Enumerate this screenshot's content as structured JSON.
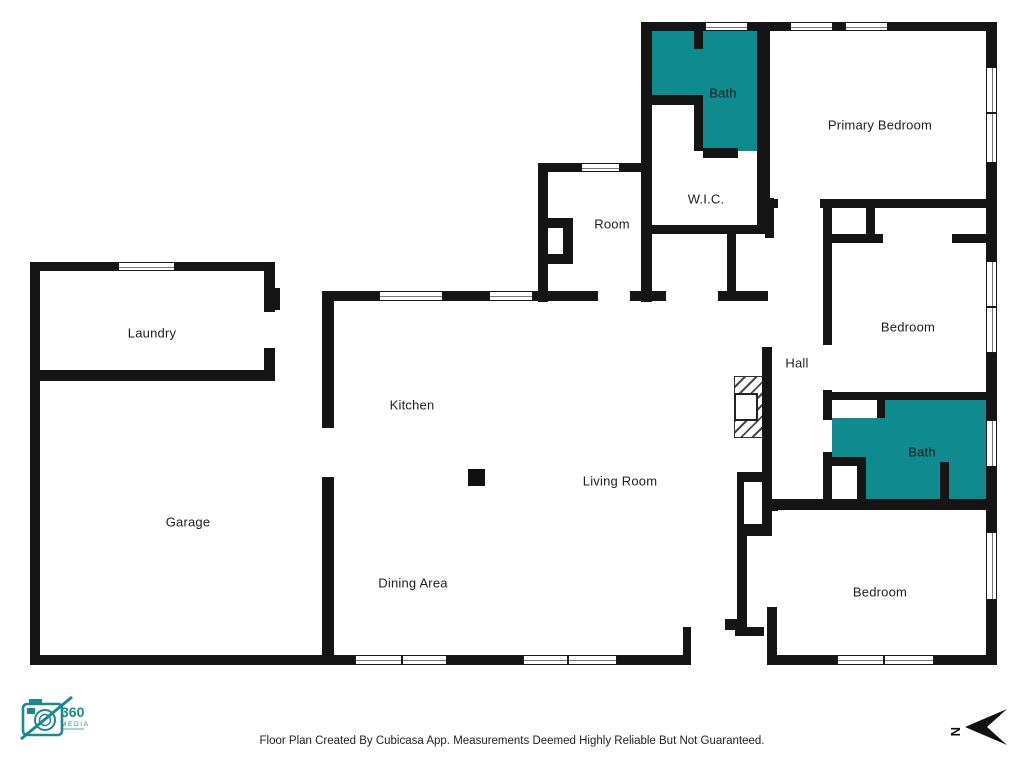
{
  "colors": {
    "wall": "#151515",
    "teal": "#0f8a8e",
    "label": "#1e1e1e",
    "logo": "#1a8a90"
  },
  "footer": {
    "disclaimer": "Floor Plan Created By Cubicasa App. Measurements Deemed Highly Reliable But Not Guaranteed."
  },
  "compass": {
    "letter": "N"
  },
  "logo": {
    "number": "360",
    "word": "MEDIA"
  },
  "plan": {
    "labels": [
      {
        "text": "Bath",
        "x": 723,
        "y": 93
      },
      {
        "text": "Primary Bedroom",
        "x": 880,
        "y": 125
      },
      {
        "text": "W.I.C.",
        "x": 706,
        "y": 199
      },
      {
        "text": "Room",
        "x": 612,
        "y": 224
      },
      {
        "text": "Laundry",
        "x": 152,
        "y": 333
      },
      {
        "text": "Kitchen",
        "x": 412,
        "y": 405
      },
      {
        "text": "Hall",
        "x": 797,
        "y": 363
      },
      {
        "text": "Bedroom",
        "x": 908,
        "y": 327
      },
      {
        "text": "Garage",
        "x": 188,
        "y": 522
      },
      {
        "text": "Living Room",
        "x": 620,
        "y": 481
      },
      {
        "text": "Bath",
        "x": 922,
        "y": 452
      },
      {
        "text": "Dining Area",
        "x": 413,
        "y": 583
      },
      {
        "text": "Bedroom",
        "x": 880,
        "y": 592
      }
    ],
    "teal_fills": [
      {
        "x": 651,
        "y": 31,
        "w": 109,
        "h": 120
      },
      {
        "x": 832,
        "y": 400,
        "w": 155,
        "h": 100
      }
    ],
    "white_insets": [
      {
        "x": 651,
        "y": 104,
        "w": 44,
        "h": 47
      },
      {
        "x": 832,
        "y": 400,
        "w": 45,
        "h": 18
      },
      {
        "x": 828,
        "y": 465,
        "w": 35,
        "h": 35
      }
    ],
    "walls": [
      {
        "x": 30,
        "y": 262,
        "w": 88,
        "h": 9
      },
      {
        "x": 175,
        "y": 262,
        "w": 100,
        "h": 9
      },
      {
        "x": 30,
        "y": 262,
        "w": 10,
        "h": 403
      },
      {
        "x": 30,
        "y": 370,
        "w": 245,
        "h": 11
      },
      {
        "x": 264,
        "y": 262,
        "w": 11,
        "h": 50
      },
      {
        "x": 264,
        "y": 348,
        "w": 11,
        "h": 33
      },
      {
        "x": 272,
        "y": 288,
        "w": 8,
        "h": 22
      },
      {
        "x": 30,
        "y": 655,
        "w": 325,
        "h": 10
      },
      {
        "x": 322,
        "y": 291,
        "w": 12,
        "h": 137
      },
      {
        "x": 322,
        "y": 477,
        "w": 12,
        "h": 188
      },
      {
        "x": 322,
        "y": 291,
        "w": 57,
        "h": 10
      },
      {
        "x": 443,
        "y": 291,
        "w": 46,
        "h": 10
      },
      {
        "x": 533,
        "y": 291,
        "w": 65,
        "h": 10
      },
      {
        "x": 630,
        "y": 291,
        "w": 36,
        "h": 10
      },
      {
        "x": 718,
        "y": 291,
        "w": 50,
        "h": 10
      },
      {
        "x": 447,
        "y": 655,
        "w": 77,
        "h": 10
      },
      {
        "x": 617,
        "y": 655,
        "w": 74,
        "h": 10
      },
      {
        "x": 683,
        "y": 627,
        "w": 8,
        "h": 38
      },
      {
        "x": 735,
        "y": 627,
        "w": 29,
        "h": 9
      },
      {
        "x": 538,
        "y": 163,
        "w": 10,
        "h": 139
      },
      {
        "x": 641,
        "y": 22,
        "w": 11,
        "h": 280
      },
      {
        "x": 538,
        "y": 163,
        "w": 43,
        "h": 9
      },
      {
        "x": 620,
        "y": 163,
        "w": 26,
        "h": 9
      },
      {
        "x": 547,
        "y": 218,
        "w": 26,
        "h": 10
      },
      {
        "x": 563,
        "y": 228,
        "w": 10,
        "h": 26
      },
      {
        "x": 547,
        "y": 254,
        "w": 26,
        "h": 10
      },
      {
        "x": 641,
        "y": 22,
        "w": 64,
        "h": 9
      },
      {
        "x": 748,
        "y": 22,
        "w": 42,
        "h": 9
      },
      {
        "x": 888,
        "y": 22,
        "w": 109,
        "h": 9
      },
      {
        "x": 833,
        "y": 22,
        "w": 12,
        "h": 9
      },
      {
        "x": 694,
        "y": 31,
        "w": 9,
        "h": 18
      },
      {
        "x": 651,
        "y": 95,
        "w": 52,
        "h": 10
      },
      {
        "x": 694,
        "y": 105,
        "w": 9,
        "h": 46
      },
      {
        "x": 703,
        "y": 148,
        "w": 35,
        "h": 10
      },
      {
        "x": 757,
        "y": 22,
        "w": 13,
        "h": 212
      },
      {
        "x": 642,
        "y": 225,
        "w": 128,
        "h": 9
      },
      {
        "x": 727,
        "y": 234,
        "w": 9,
        "h": 67
      },
      {
        "x": 767,
        "y": 199,
        "w": 11,
        "h": 9
      },
      {
        "x": 820,
        "y": 199,
        "w": 177,
        "h": 9
      },
      {
        "x": 986,
        "y": 22,
        "w": 11,
        "h": 45
      },
      {
        "x": 986,
        "y": 163,
        "w": 11,
        "h": 45
      },
      {
        "x": 765,
        "y": 198,
        "w": 9,
        "h": 40
      },
      {
        "x": 762,
        "y": 347,
        "w": 10,
        "h": 189
      },
      {
        "x": 737,
        "y": 472,
        "w": 32,
        "h": 10
      },
      {
        "x": 737,
        "y": 482,
        "w": 7,
        "h": 42
      },
      {
        "x": 737,
        "y": 524,
        "w": 32,
        "h": 12
      },
      {
        "x": 772,
        "y": 500,
        "w": 6,
        "h": 11
      },
      {
        "x": 737,
        "y": 536,
        "w": 10,
        "h": 92
      },
      {
        "x": 725,
        "y": 619,
        "w": 12,
        "h": 11
      },
      {
        "x": 767,
        "y": 607,
        "w": 10,
        "h": 50
      },
      {
        "x": 823,
        "y": 199,
        "w": 9,
        "h": 146
      },
      {
        "x": 823,
        "y": 390,
        "w": 9,
        "h": 30
      },
      {
        "x": 823,
        "y": 452,
        "w": 9,
        "h": 55
      },
      {
        "x": 866,
        "y": 207,
        "w": 9,
        "h": 35
      },
      {
        "x": 823,
        "y": 234,
        "w": 60,
        "h": 9
      },
      {
        "x": 952,
        "y": 234,
        "w": 36,
        "h": 9
      },
      {
        "x": 986,
        "y": 208,
        "w": 11,
        "h": 53
      },
      {
        "x": 986,
        "y": 353,
        "w": 11,
        "h": 40
      },
      {
        "x": 823,
        "y": 392,
        "w": 167,
        "h": 8
      },
      {
        "x": 877,
        "y": 400,
        "w": 8,
        "h": 18
      },
      {
        "x": 823,
        "y": 457,
        "w": 42,
        "h": 9
      },
      {
        "x": 857,
        "y": 457,
        "w": 9,
        "h": 43
      },
      {
        "x": 940,
        "y": 462,
        "w": 9,
        "h": 38
      },
      {
        "x": 986,
        "y": 393,
        "w": 11,
        "h": 27
      },
      {
        "x": 986,
        "y": 467,
        "w": 11,
        "h": 40
      },
      {
        "x": 767,
        "y": 499,
        "w": 230,
        "h": 11
      },
      {
        "x": 986,
        "y": 510,
        "w": 11,
        "h": 22
      },
      {
        "x": 986,
        "y": 600,
        "w": 11,
        "h": 65
      },
      {
        "x": 767,
        "y": 655,
        "w": 70,
        "h": 10
      },
      {
        "x": 934,
        "y": 655,
        "w": 63,
        "h": 10
      }
    ],
    "windows": [
      {
        "x": 118,
        "y": 262,
        "w": 57,
        "h": 9,
        "o": "h"
      },
      {
        "x": 379,
        "y": 291,
        "w": 64,
        "h": 10,
        "o": "h"
      },
      {
        "x": 489,
        "y": 291,
        "w": 44,
        "h": 10,
        "o": "h"
      },
      {
        "x": 581,
        "y": 163,
        "w": 39,
        "h": 9,
        "o": "h"
      },
      {
        "x": 705,
        "y": 22,
        "w": 43,
        "h": 9,
        "o": "h"
      },
      {
        "x": 790,
        "y": 22,
        "w": 43,
        "h": 9,
        "o": "h"
      },
      {
        "x": 845,
        "y": 22,
        "w": 43,
        "h": 9,
        "o": "h"
      },
      {
        "x": 986,
        "y": 67,
        "w": 11,
        "h": 46,
        "o": "v"
      },
      {
        "x": 986,
        "y": 113,
        "w": 11,
        "h": 50,
        "o": "v"
      },
      {
        "x": 986,
        "y": 261,
        "w": 11,
        "h": 46,
        "o": "v"
      },
      {
        "x": 986,
        "y": 307,
        "w": 11,
        "h": 46,
        "o": "v"
      },
      {
        "x": 986,
        "y": 420,
        "w": 11,
        "h": 47,
        "o": "v"
      },
      {
        "x": 986,
        "y": 532,
        "w": 11,
        "h": 68,
        "o": "v"
      },
      {
        "x": 837,
        "y": 655,
        "w": 47,
        "h": 10,
        "o": "h"
      },
      {
        "x": 884,
        "y": 655,
        "w": 50,
        "h": 10,
        "o": "h"
      },
      {
        "x": 355,
        "y": 655,
        "w": 47,
        "h": 10,
        "o": "h"
      },
      {
        "x": 402,
        "y": 655,
        "w": 45,
        "h": 10,
        "o": "h"
      },
      {
        "x": 523,
        "y": 655,
        "w": 45,
        "h": 10,
        "o": "h"
      },
      {
        "x": 568,
        "y": 655,
        "w": 49,
        "h": 10,
        "o": "h"
      }
    ],
    "fireplace": {
      "x": 734,
      "y": 376,
      "w": 36,
      "h": 62,
      "box": {
        "x": -1,
        "y": 16,
        "w": 24,
        "h": 28
      }
    },
    "pillar": {
      "x": 468,
      "y": 469,
      "w": 17,
      "h": 17
    }
  }
}
